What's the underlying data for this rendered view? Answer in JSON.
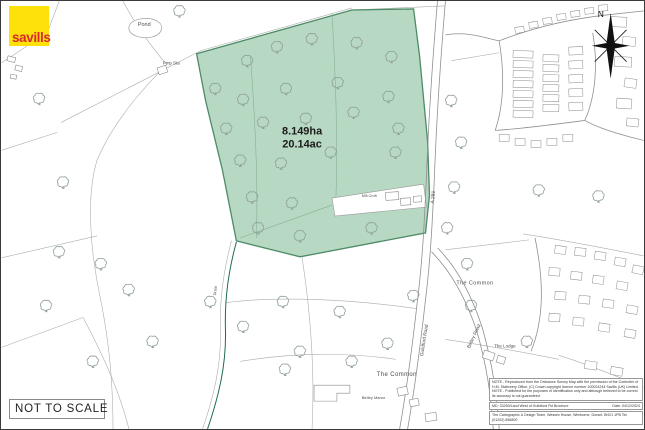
{
  "logo": {
    "brand": "savills"
  },
  "compass": {
    "north_label": "N"
  },
  "plot": {
    "area_hectares": "8.149ha",
    "area_acres": "20.14ac"
  },
  "map_labels": {
    "pond": "Pond",
    "pump_station": "Pmp Sta",
    "road_number": "A 281",
    "guildford_road": "Guildford Road",
    "birtley_road": "Birtley Road",
    "the_common_east": "The Common",
    "the_common_south": "The Common",
    "the_lodge": "The Lodge",
    "manor": "Birtley Manor",
    "mill_property": "Mill Croft",
    "drain": "Drain"
  },
  "scale_note": "NOT TO SCALE",
  "notes_box": {
    "note1": "NOTE - Reproduced from the Ordnance Survey Map with the permission of the Controller of H.M. Stationery Office. (C) Crown copyright licence number 100024244 Savills (UK) Limited.",
    "note2": "NOTE - Published for the purposes of identification only and although believed to be correct its accuracy is not guaranteed.",
    "reference": "MD: 33250/Land West of Guildford Rd Brochure",
    "date": "Date: 04/12/2024",
    "cartography": "The Cartographic & Design Team, Wessex House, Wimborne, Dorset. BH21 1PB Tel: (01202) 856800"
  },
  "colors": {
    "plot_fill": "#b7d8c2",
    "plot_outline": "#4d8a66",
    "savills_yellow": "#ffe10a",
    "savills_red": "#d7282f",
    "stream": "#1f6b54"
  }
}
